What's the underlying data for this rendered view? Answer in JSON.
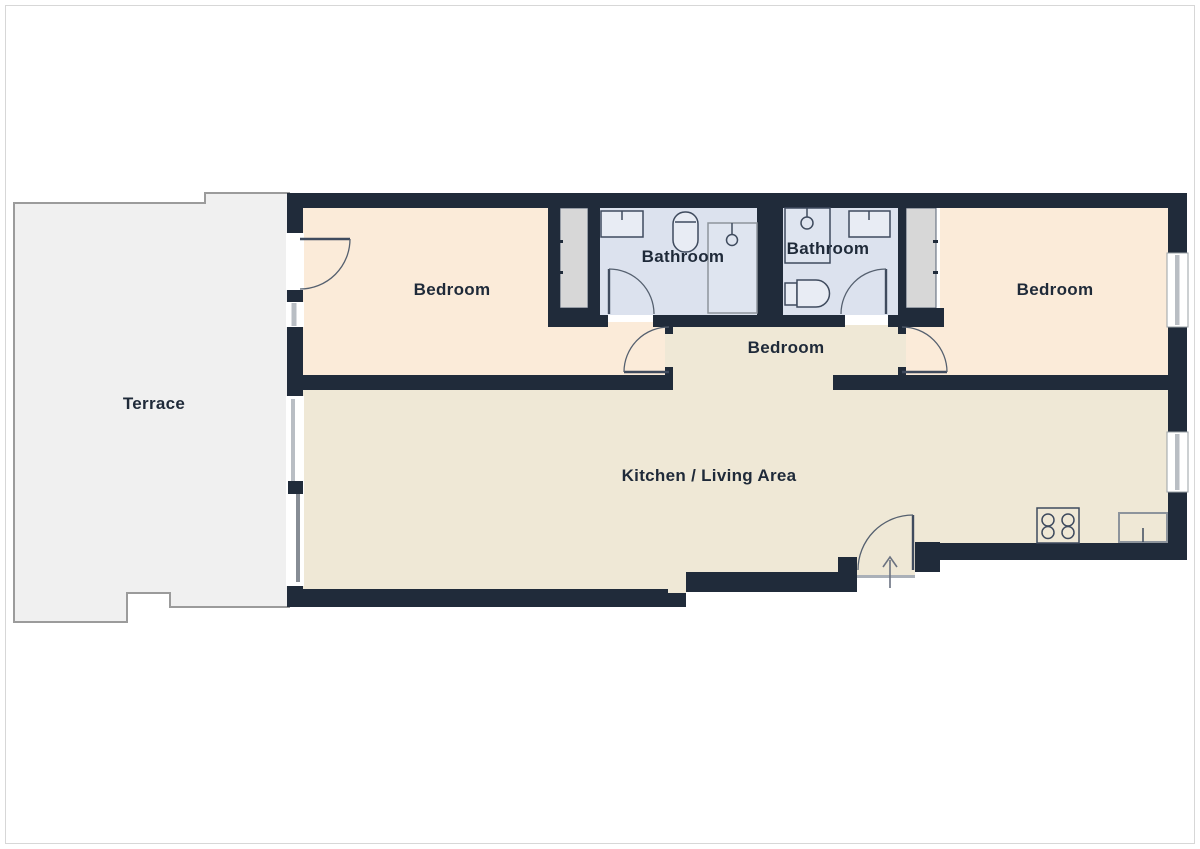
{
  "floorplan": {
    "title": "apartment-floor-plan",
    "rooms": [
      {
        "id": "terrace",
        "label": "Terrace"
      },
      {
        "id": "bedroom-left",
        "label": "Bedroom"
      },
      {
        "id": "bathroom-left",
        "label": "Bathroom"
      },
      {
        "id": "bathroom-right",
        "label": "Bathroom"
      },
      {
        "id": "bedroom-middle",
        "label": "Bedroom"
      },
      {
        "id": "bedroom-right",
        "label": "Bedroom"
      },
      {
        "id": "kitchen-living",
        "label": "Kitchen / Living Area"
      }
    ],
    "fixtures": [
      "wardrobe-left",
      "wardrobe-right",
      "basin-left-bathroom",
      "toilet-left-bathroom",
      "shower-left-bathroom",
      "shower-right-bathroom",
      "basin-right-bathroom",
      "toilet-right-bathroom",
      "stove-4-burner",
      "kitchen-sink",
      "entrance-door",
      "terrace-door",
      "sliding-glass-door",
      "window-right-bedroom",
      "window-kitchen",
      "window-left-bedroom"
    ],
    "colors": {
      "wall": "#202b3a",
      "bedroom_floor": "#fbebd9",
      "living_floor": "#efe8d6",
      "bathroom_floor": "#dce2ee",
      "bathroom_fixture": "#e8ecf4",
      "terrace_floor": "#f0f0f0",
      "wardrobe_fill": "#d7d7d7",
      "door_line": "#55606f",
      "glazing": "#b9bec4",
      "label_text": "#1f2a39",
      "frame_border": "#d7d7d7"
    }
  }
}
